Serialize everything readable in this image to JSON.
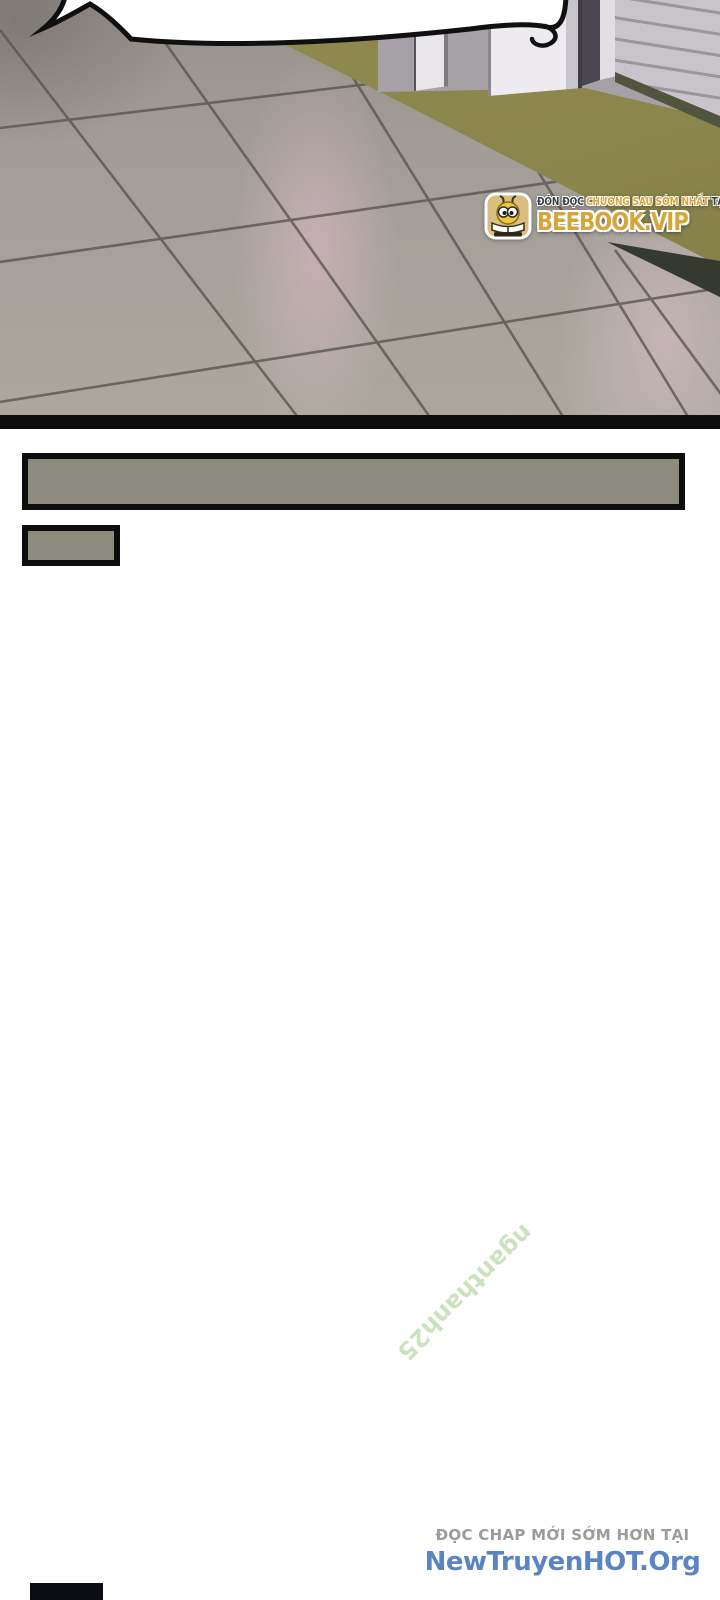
{
  "panel": {
    "type": "comic-page-image",
    "scene": "tiled floor in perspective with storefront shutter door, empty spiky speech bubble at top",
    "colors": {
      "floor": "#a49f99",
      "floor_sheen": "#dfbcc8",
      "olive_band": "#8a854b",
      "wall": "#a5a1a6",
      "pillar": "#eeebf0",
      "shutter": "#c8c4c9",
      "bubble_fill": "#ffffff",
      "outline": "#0e0e0e"
    },
    "caption_boxes": {
      "fill": "#8c8b7e",
      "border": "#0d0d0d"
    }
  },
  "badge": {
    "line1": {
      "prefix": "ĐÓN ĐỌC",
      "highlight": "CHƯƠNG SAU SỚM NHẤT",
      "suffix": "TẠI"
    },
    "brand": "BEEBOOK.VIP",
    "icon": "bee-mascot-icon",
    "colors": {
      "gold": "#d7a63a",
      "dark": "#3b3f42",
      "icon_bg": "#d9bf7e"
    }
  },
  "reader": {
    "watermark": {
      "text": "nganthanh25",
      "color": "#9ecc86",
      "rotation_deg": 135
    },
    "promo": {
      "heading": "ĐỌC CHAP MỚI SỚM HƠN TẠI",
      "site": "NewTruyenHOT.Org",
      "heading_color": "#9b9b9b",
      "site_color": "#5b84c4"
    }
  }
}
